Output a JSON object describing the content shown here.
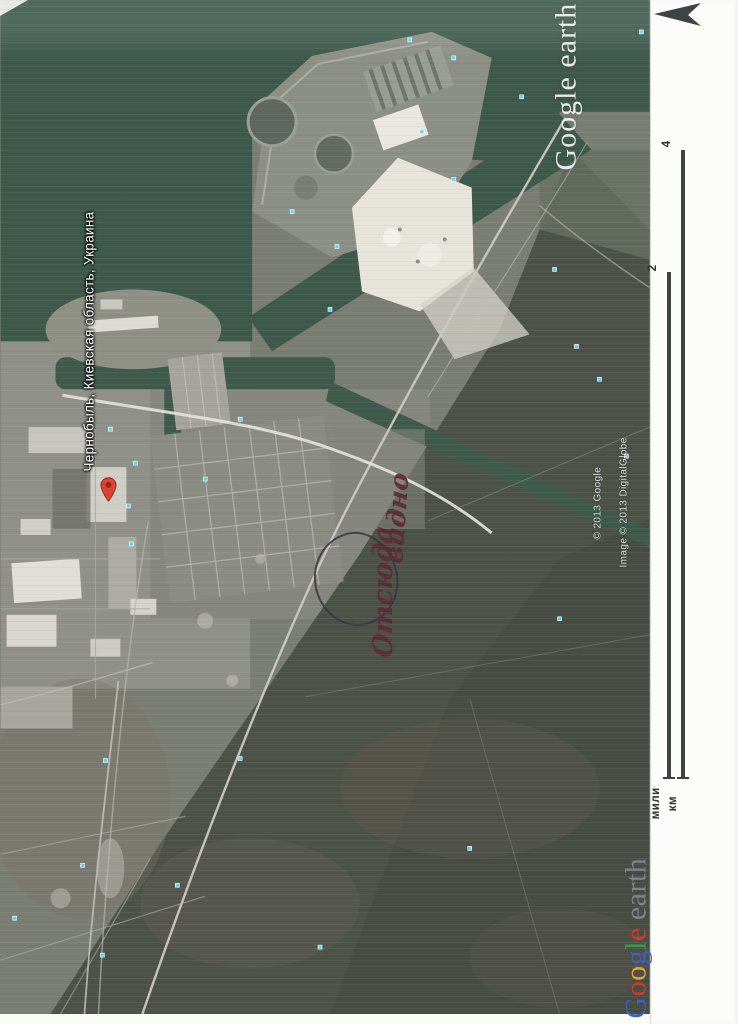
{
  "map": {
    "place_label": "Чернобыль, Киевская область, Украина",
    "watermark": {
      "text": "Google earth"
    },
    "credits": {
      "google": "© 2013 Google",
      "digitalglobe": "Image © 2013 DigitalGlobe"
    },
    "annotation": {
      "word1": "Отсюда",
      "word2": "видно",
      "ink_color": "#5d2a35"
    },
    "colors": {
      "water": "#3d594b",
      "terrain": "#7a7d73",
      "forest": "#4d5249",
      "sand": "#e7e4db",
      "photo_marker": "#5fd6ea",
      "pin": "#e3402f"
    }
  },
  "margin": {
    "scale_bar": {
      "miles_value": "2",
      "miles_label": "мили",
      "km_value": "4",
      "km_label": "км"
    },
    "logo": {
      "letters": [
        {
          "ch": "G",
          "color": "#3a63c2"
        },
        {
          "ch": "o",
          "color": "#d23a2c"
        },
        {
          "ch": "o",
          "color": "#e8a32f"
        },
        {
          "ch": "g",
          "color": "#3a63c2"
        },
        {
          "ch": "l",
          "color": "#36a04a"
        },
        {
          "ch": "e",
          "color": "#d23a2c"
        }
      ],
      "earth_label": "earth",
      "earth_color": "#7e8488"
    },
    "north_arrow_color": "#3d4446"
  }
}
